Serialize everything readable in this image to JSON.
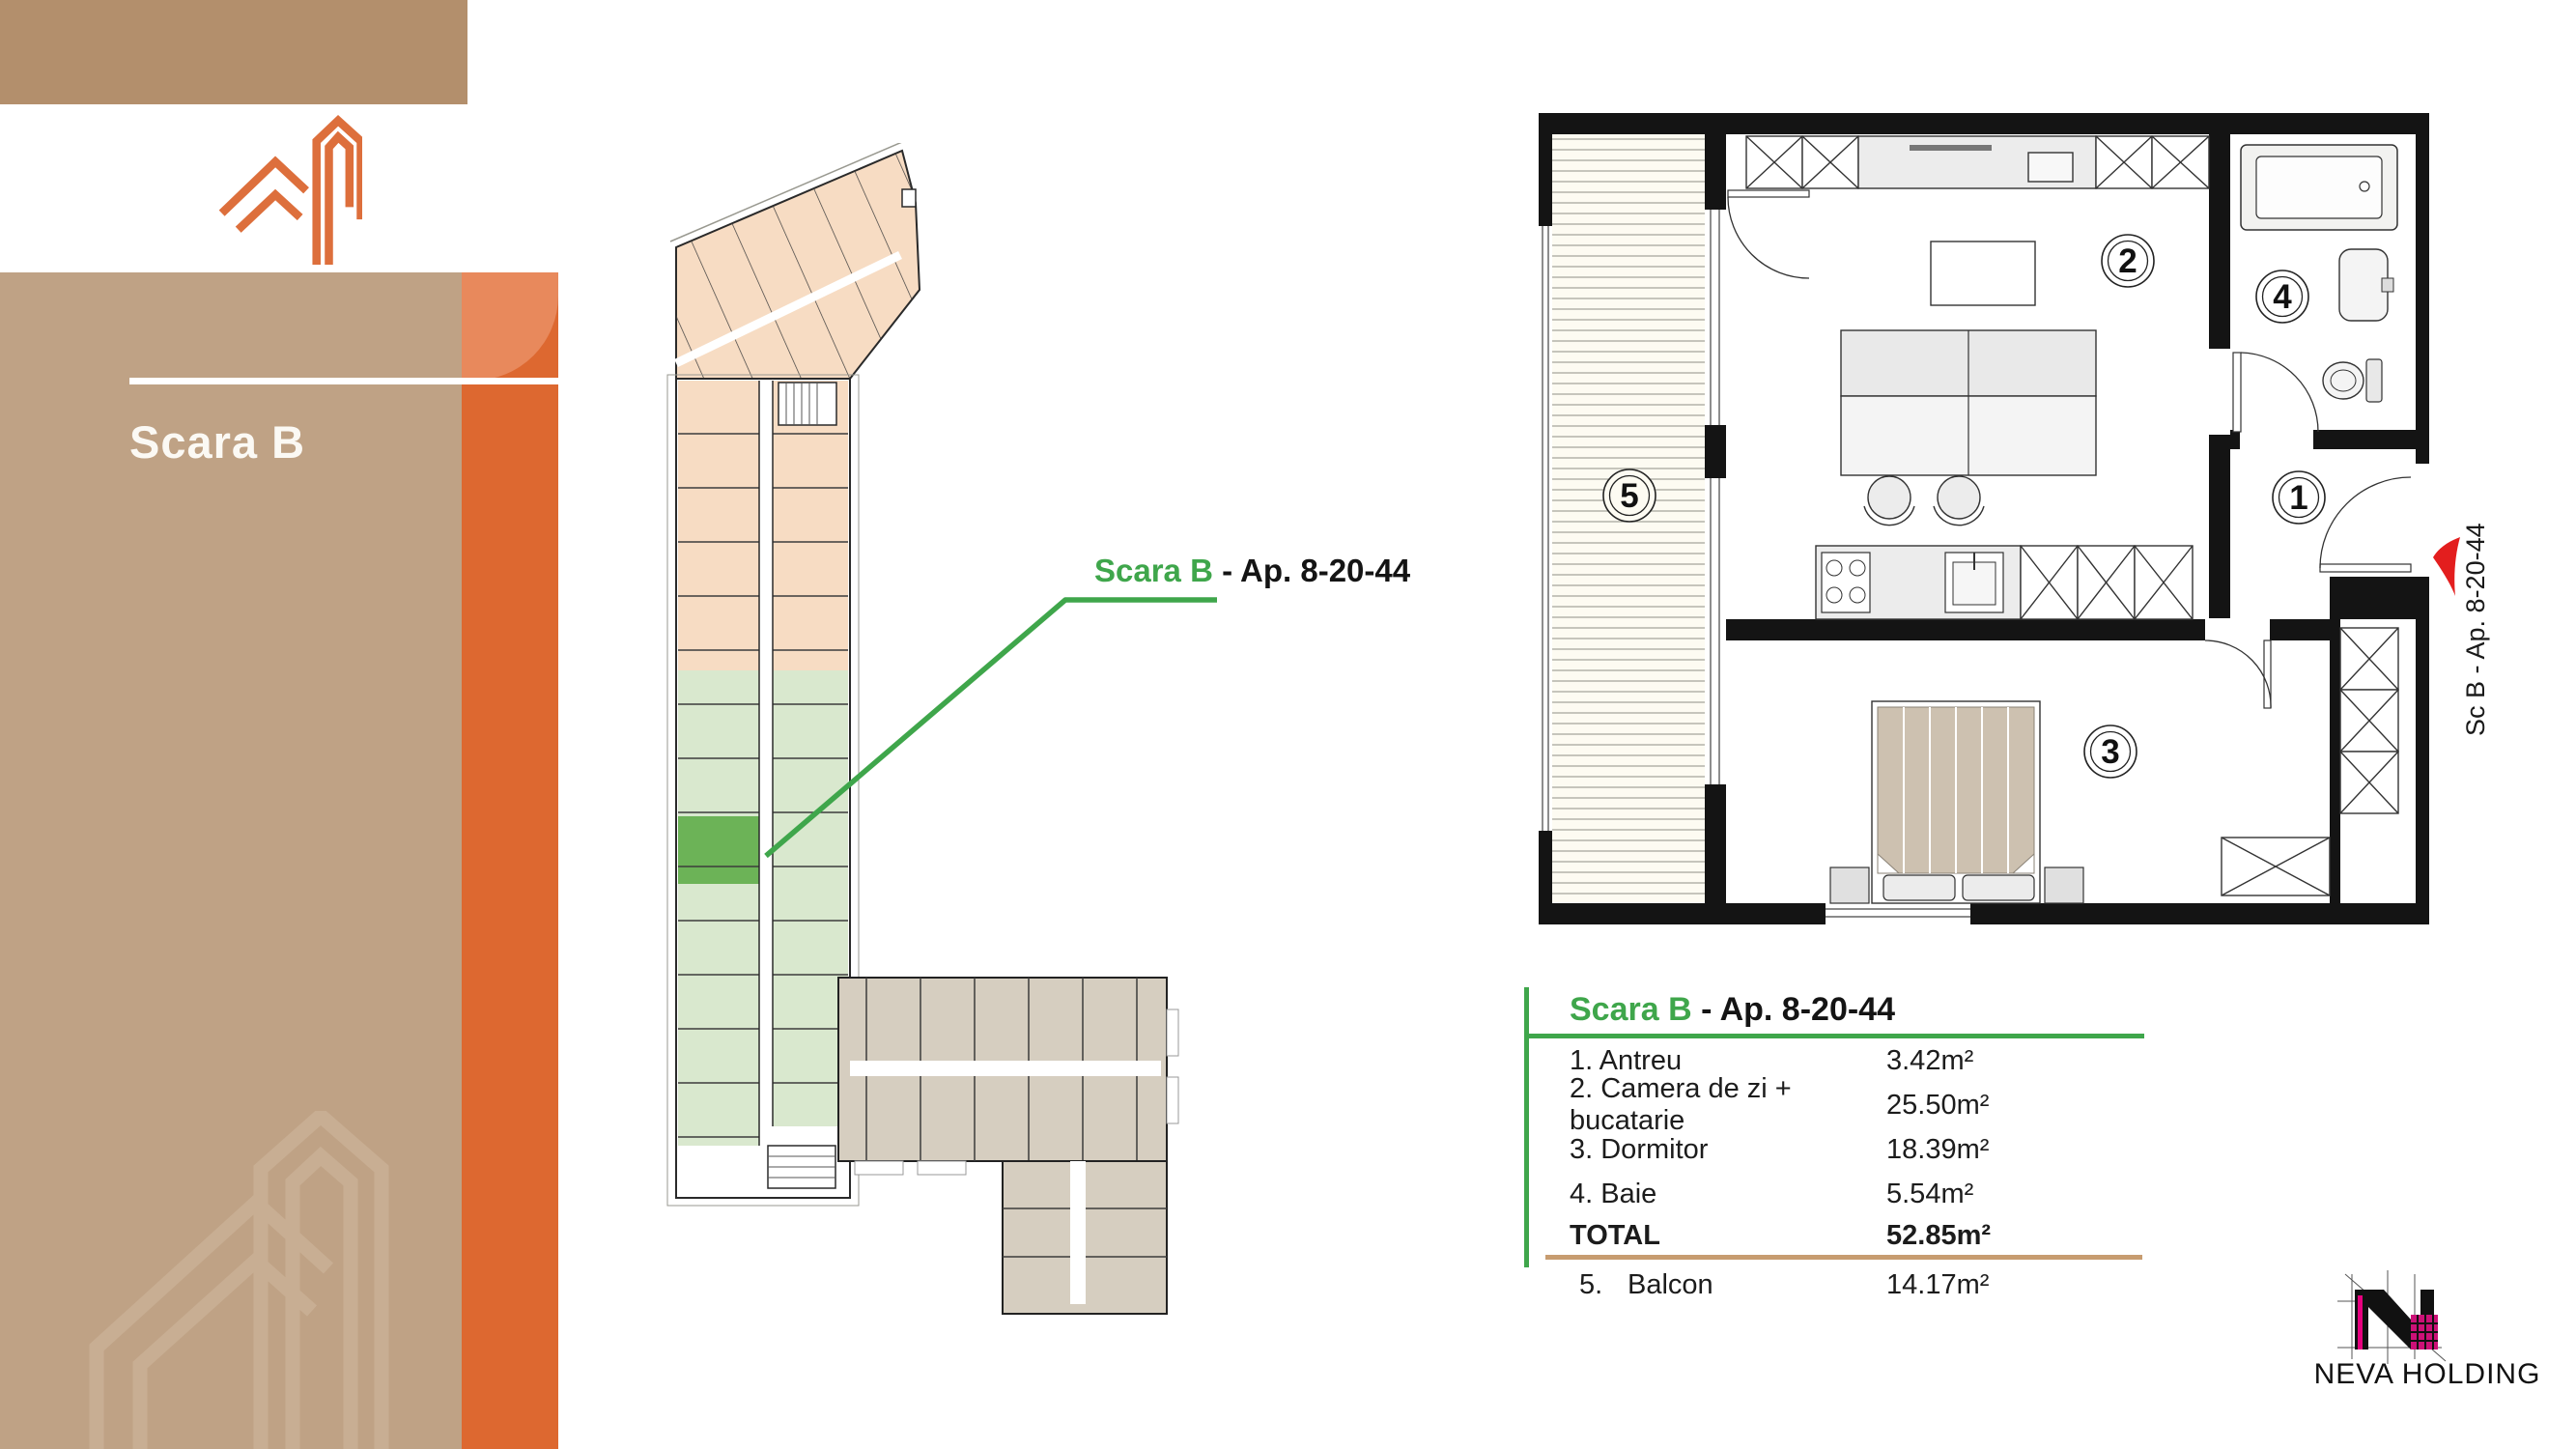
{
  "sidebar": {
    "brand": {
      "name": "SOPORULUI",
      "number": "19"
    },
    "heading": "Scara B"
  },
  "overview_label": {
    "highlight": "Scara B",
    "rest": " - Ap. 8-20-44"
  },
  "plan": {
    "room_numbers": {
      "antreu": "1",
      "living": "2",
      "dormitor": "3",
      "baie": "4",
      "balcon": "5"
    },
    "entrance_label": "Sc B - Ap. 8-20-44"
  },
  "table": {
    "title": {
      "highlight": "Scara B",
      "rest": " - Ap. 8-20-44"
    },
    "rows": [
      {
        "label": "1. Antreu",
        "area": "3.42m²"
      },
      {
        "label": "2. Camera de zi + bucatarie",
        "area": "25.50m²"
      },
      {
        "label": "3. Dormitor",
        "area": "18.39m²"
      },
      {
        "label": "4. Baie",
        "area": "5.54m²"
      }
    ],
    "total": {
      "label": "TOTAL",
      "area": "52.85m²"
    },
    "balcony": {
      "num": "5.",
      "label": "Balcon",
      "area": "14.17m²"
    }
  },
  "footer": {
    "company": "NEVA HOLDING"
  },
  "colors": {
    "accent_green": "#3fa64b",
    "accent_orange": "#dd6830",
    "tan": "#bfa285",
    "tan_dark": "#b38f6c",
    "unit_peach": "#f7dcc3",
    "unit_green": "#d9e8ce",
    "unit_green_selected": "#6cb357",
    "unit_gray": "#d6cec0",
    "entrance_red": "#e31e1e"
  }
}
